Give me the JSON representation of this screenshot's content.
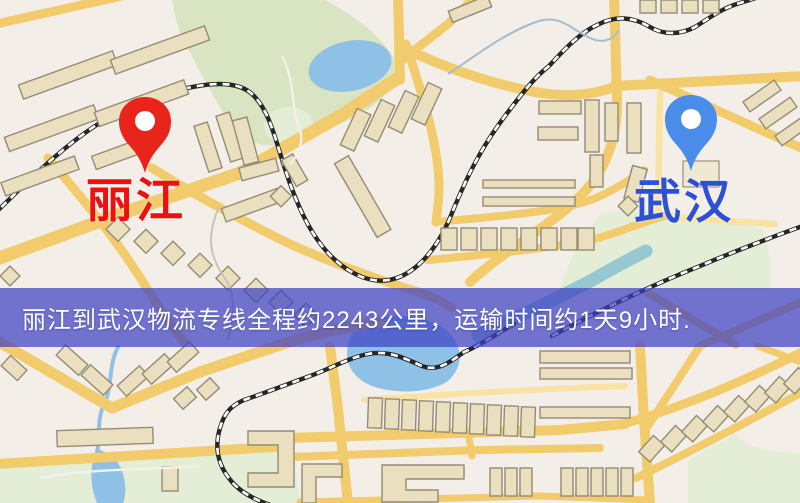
{
  "map": {
    "origin": {
      "name": "丽江",
      "pin": "red-location-pin",
      "pin_color": "#e8241b",
      "label_color": "#ee0f0f"
    },
    "destination": {
      "name": "武汉",
      "pin": "blue-location-pin",
      "pin_color": "#4a8cea",
      "label_color": "#2d50d5"
    },
    "banner": {
      "text": "丽江到武汉物流专线全程约2243公里，运输时间约1天9小时.",
      "background": "#3d41c4b8",
      "text_color": "#ffffff"
    },
    "palette": {
      "background": "#f3efe8",
      "road": "#f2cc6c",
      "road_minor": "#f8e3a4",
      "building": "#eae0bf",
      "building_stroke": "#948b74",
      "park": "#d9e4c2",
      "water": "#8fc0e6",
      "river": "#8cc3cf",
      "railway": "#262626"
    }
  }
}
